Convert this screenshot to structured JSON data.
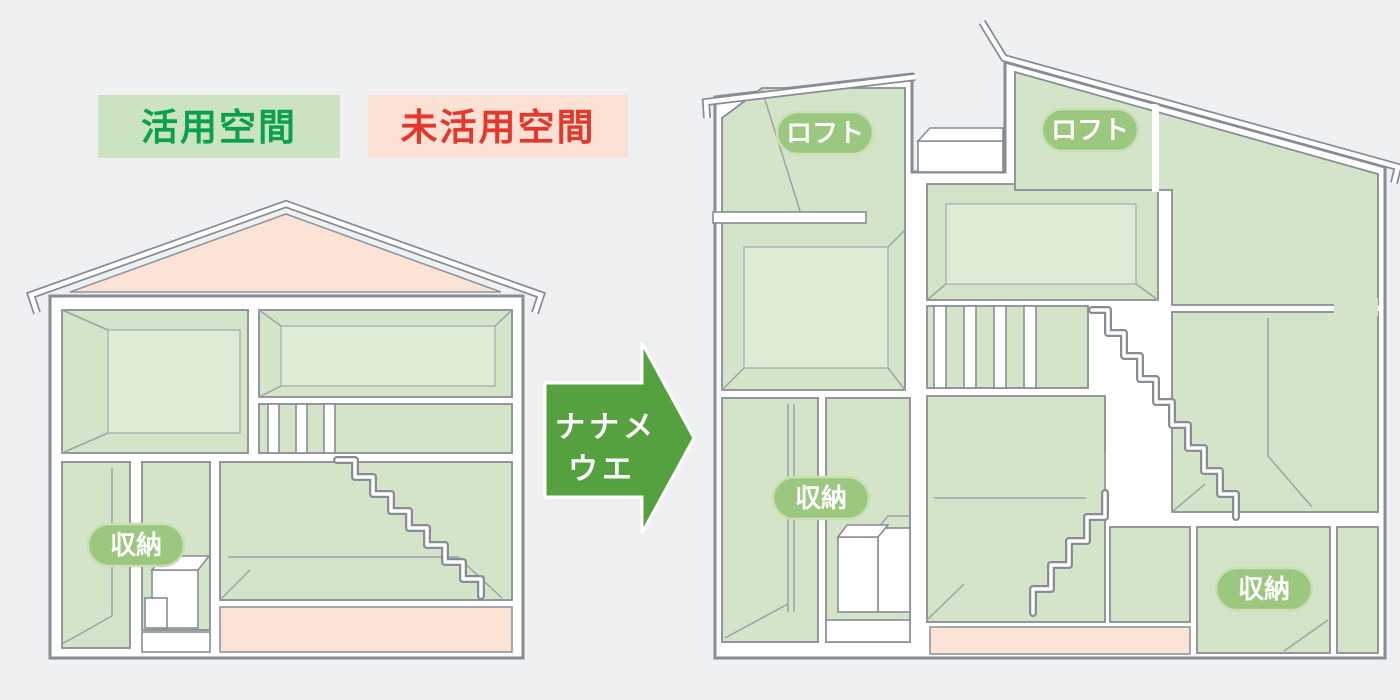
{
  "diagram": {
    "type": "house-cross-section-comparison",
    "legend": {
      "utilized_label": "活用空間",
      "unutilized_label": "未活用空間"
    },
    "arrow": {
      "line1": "ナナメ",
      "line2": "ウエ"
    },
    "before_house": {
      "storage_label": "収納"
    },
    "after_house": {
      "loft_left_label": "ロフト",
      "loft_right_label": "ロフト",
      "storage_left_label": "収納",
      "storage_right_label": "収納"
    },
    "colors": {
      "background": "#eef0f1",
      "utilized_green": "#d3e4c9",
      "utilized_green_light": "#deecd4",
      "unutilized_pink": "#fbe3d6",
      "legend_green_bg": "#cbe3c1",
      "legend_green_text": "#0aa050",
      "legend_pink_bg": "#fbe0d4",
      "legend_red_text": "#e5382d",
      "arrow_green": "#55a03f",
      "label_pill_green": "#9cc77e",
      "wall_gray": "#878d93"
    }
  }
}
